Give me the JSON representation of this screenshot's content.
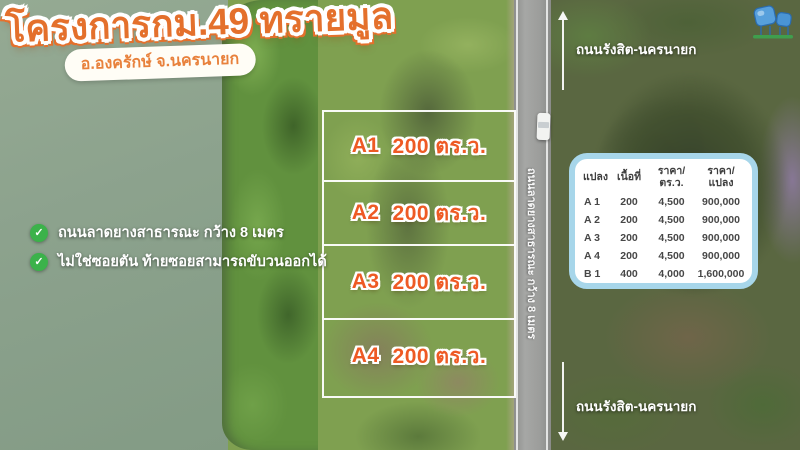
{
  "project": {
    "title": "โครงการกม.49 ทรายมูล",
    "location_badge": "อ.องครักษ์ จ.นครนายก"
  },
  "features": [
    "ถนนลาดยางสาธารณะ กว้าง 8 เมตร",
    "ไม่ใช่ซอยตัน ท้ายซอยสามารถขับวนออกได้"
  ],
  "plots": [
    {
      "id": "A1",
      "size": "200 ตร.ว."
    },
    {
      "id": "A2",
      "size": "200 ตร.ว."
    },
    {
      "id": "A3",
      "size": "200 ตร.ว."
    },
    {
      "id": "A4",
      "size": "200 ตร.ว."
    }
  ],
  "road": {
    "name_top": "ถนนรังสิต-นครนายก",
    "name_bottom": "ถนนรังสิต-นครนายก",
    "surface_note": "ถนนลาดยางสาธารณะ กว้าง 8 เมตร"
  },
  "price_table": {
    "col_plot": "แปลง",
    "col_area": "เนื้อที่",
    "col_price_per_wa": [
      "ราคา/",
      "ตร.ว."
    ],
    "col_price_per_plot": [
      "ราคา/",
      "แปลง"
    ],
    "rows": [
      {
        "plot": "A 1",
        "area": "200",
        "price_per_wa": "4,500",
        "price_per_plot": "900,000"
      },
      {
        "plot": "A 2",
        "area": "200",
        "price_per_wa": "4,500",
        "price_per_plot": "900,000"
      },
      {
        "plot": "A 3",
        "area": "200",
        "price_per_wa": "4,500",
        "price_per_plot": "900,000"
      },
      {
        "plot": "A 4",
        "area": "200",
        "price_per_wa": "4,500",
        "price_per_plot": "900,000"
      },
      {
        "plot": "B 1",
        "area": "400",
        "price_per_wa": "4,000",
        "price_per_plot": "1,600,000"
      }
    ]
  },
  "icons": {
    "check": "✓"
  },
  "colors": {
    "title_orange": "#e4702c",
    "plot_label_orange": "#ee5a24",
    "check_green": "#3bb24a",
    "table_border_blue": "#a7d6ea",
    "logo_blue": "#4f9bd8"
  }
}
